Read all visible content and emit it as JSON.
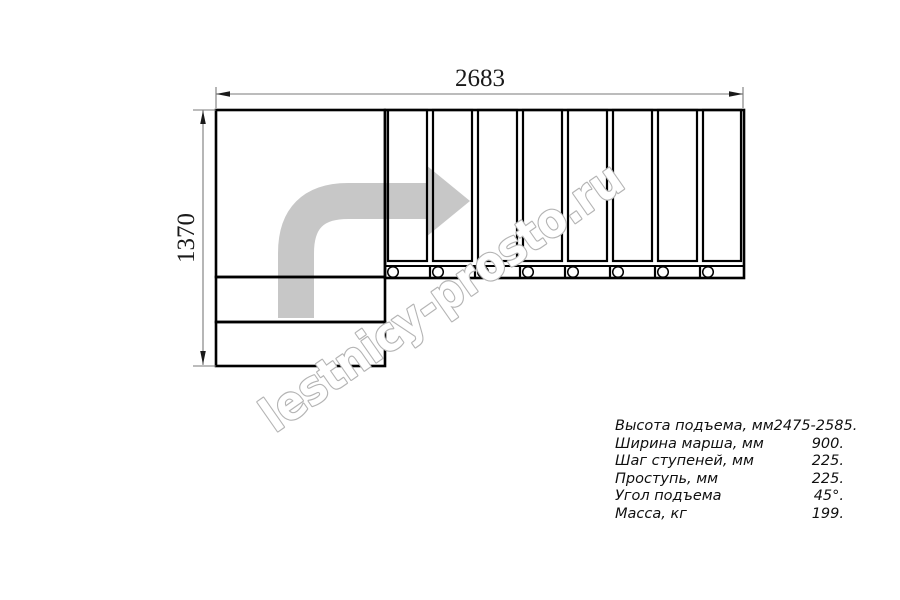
{
  "drawing": {
    "type": "staircase-plan-top-view",
    "dim_width_label": "2683",
    "dim_height_label": "1370",
    "tread_count": 8,
    "watermark_text": "lestnicy-prosto.ru",
    "colors": {
      "line": "#000000",
      "dim_line": "#7a7a7a",
      "dim_text": "#1a1a1a",
      "arrow_gray": "#c7c7c7",
      "watermark_outline": "#b4b4b4",
      "watermark_fill": "#ffffff"
    }
  },
  "specs": {
    "rows": [
      {
        "label": "Высота подъема, мм",
        "value": "2475-2585."
      },
      {
        "label": "Ширина марша, мм",
        "value": "900."
      },
      {
        "label": "Шаг ступеней, мм",
        "value": "225."
      },
      {
        "label": "Проступь, мм",
        "value": "225."
      },
      {
        "label": "Угол подъема",
        "value": "45°."
      },
      {
        "label": "Масса, кг",
        "value": "199."
      }
    ]
  }
}
